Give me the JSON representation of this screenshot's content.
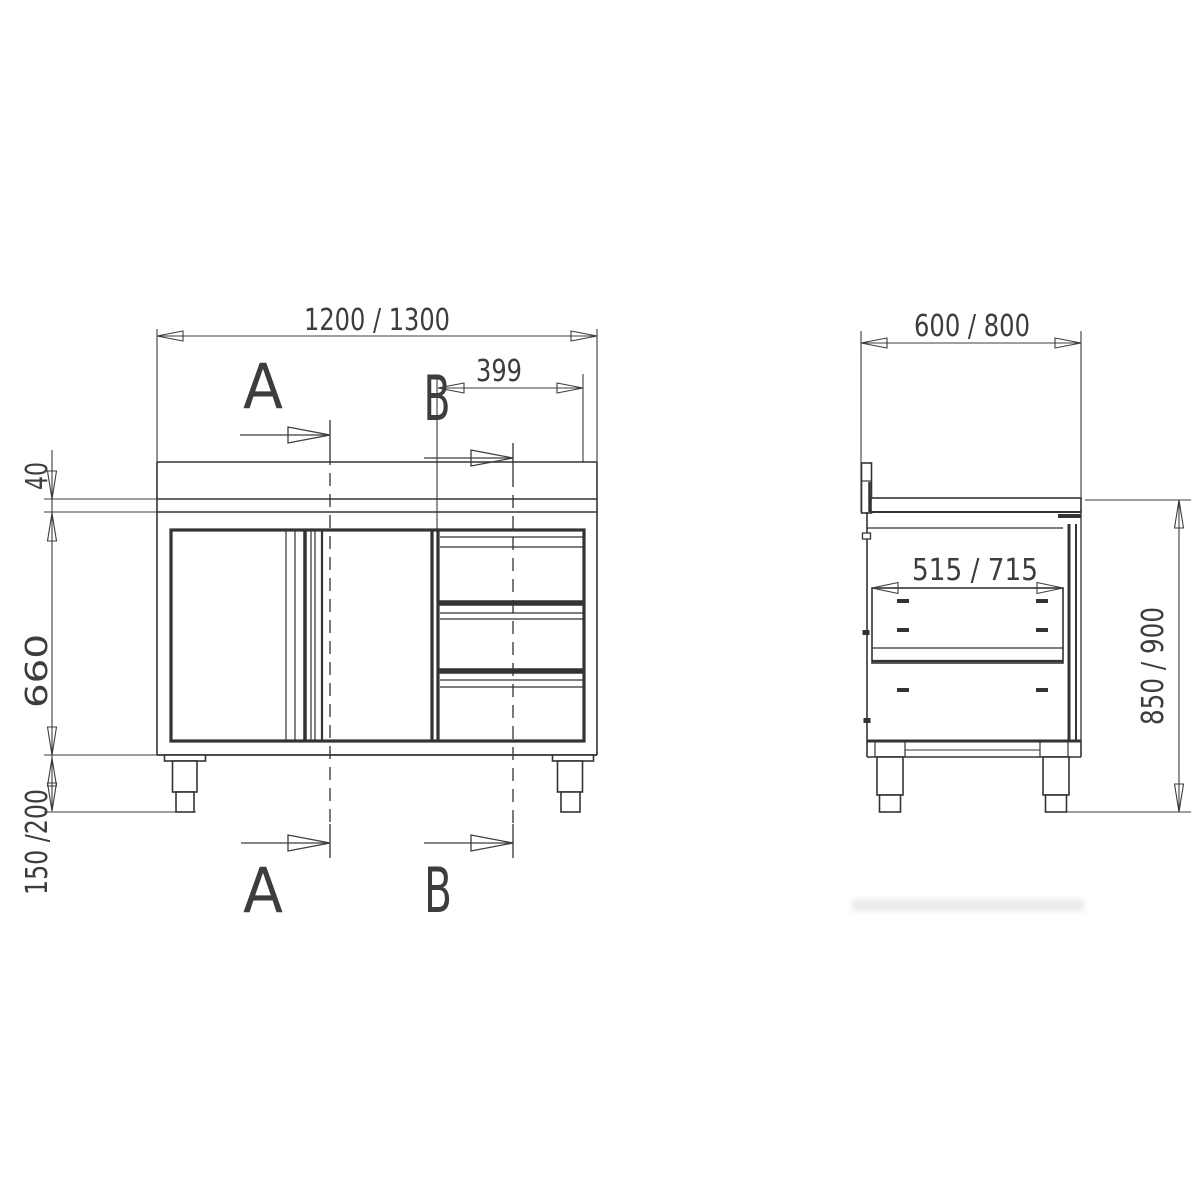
{
  "front_view": {
    "dim_overall_width": "1200 / 1300",
    "dim_drawer_unit_width": "399",
    "dim_worktop_thickness": "40",
    "dim_body_height": "660",
    "dim_leg_height": "150 /200",
    "section_label_a": "A",
    "section_label_b": "B"
  },
  "side_view": {
    "dim_overall_depth": "600 / 800",
    "dim_inner_depth": "515 / 715",
    "dim_overall_height": "850 / 900"
  },
  "colors": {
    "line": "#333333",
    "dimension": "#3d3d3d",
    "background": "#ffffff"
  }
}
